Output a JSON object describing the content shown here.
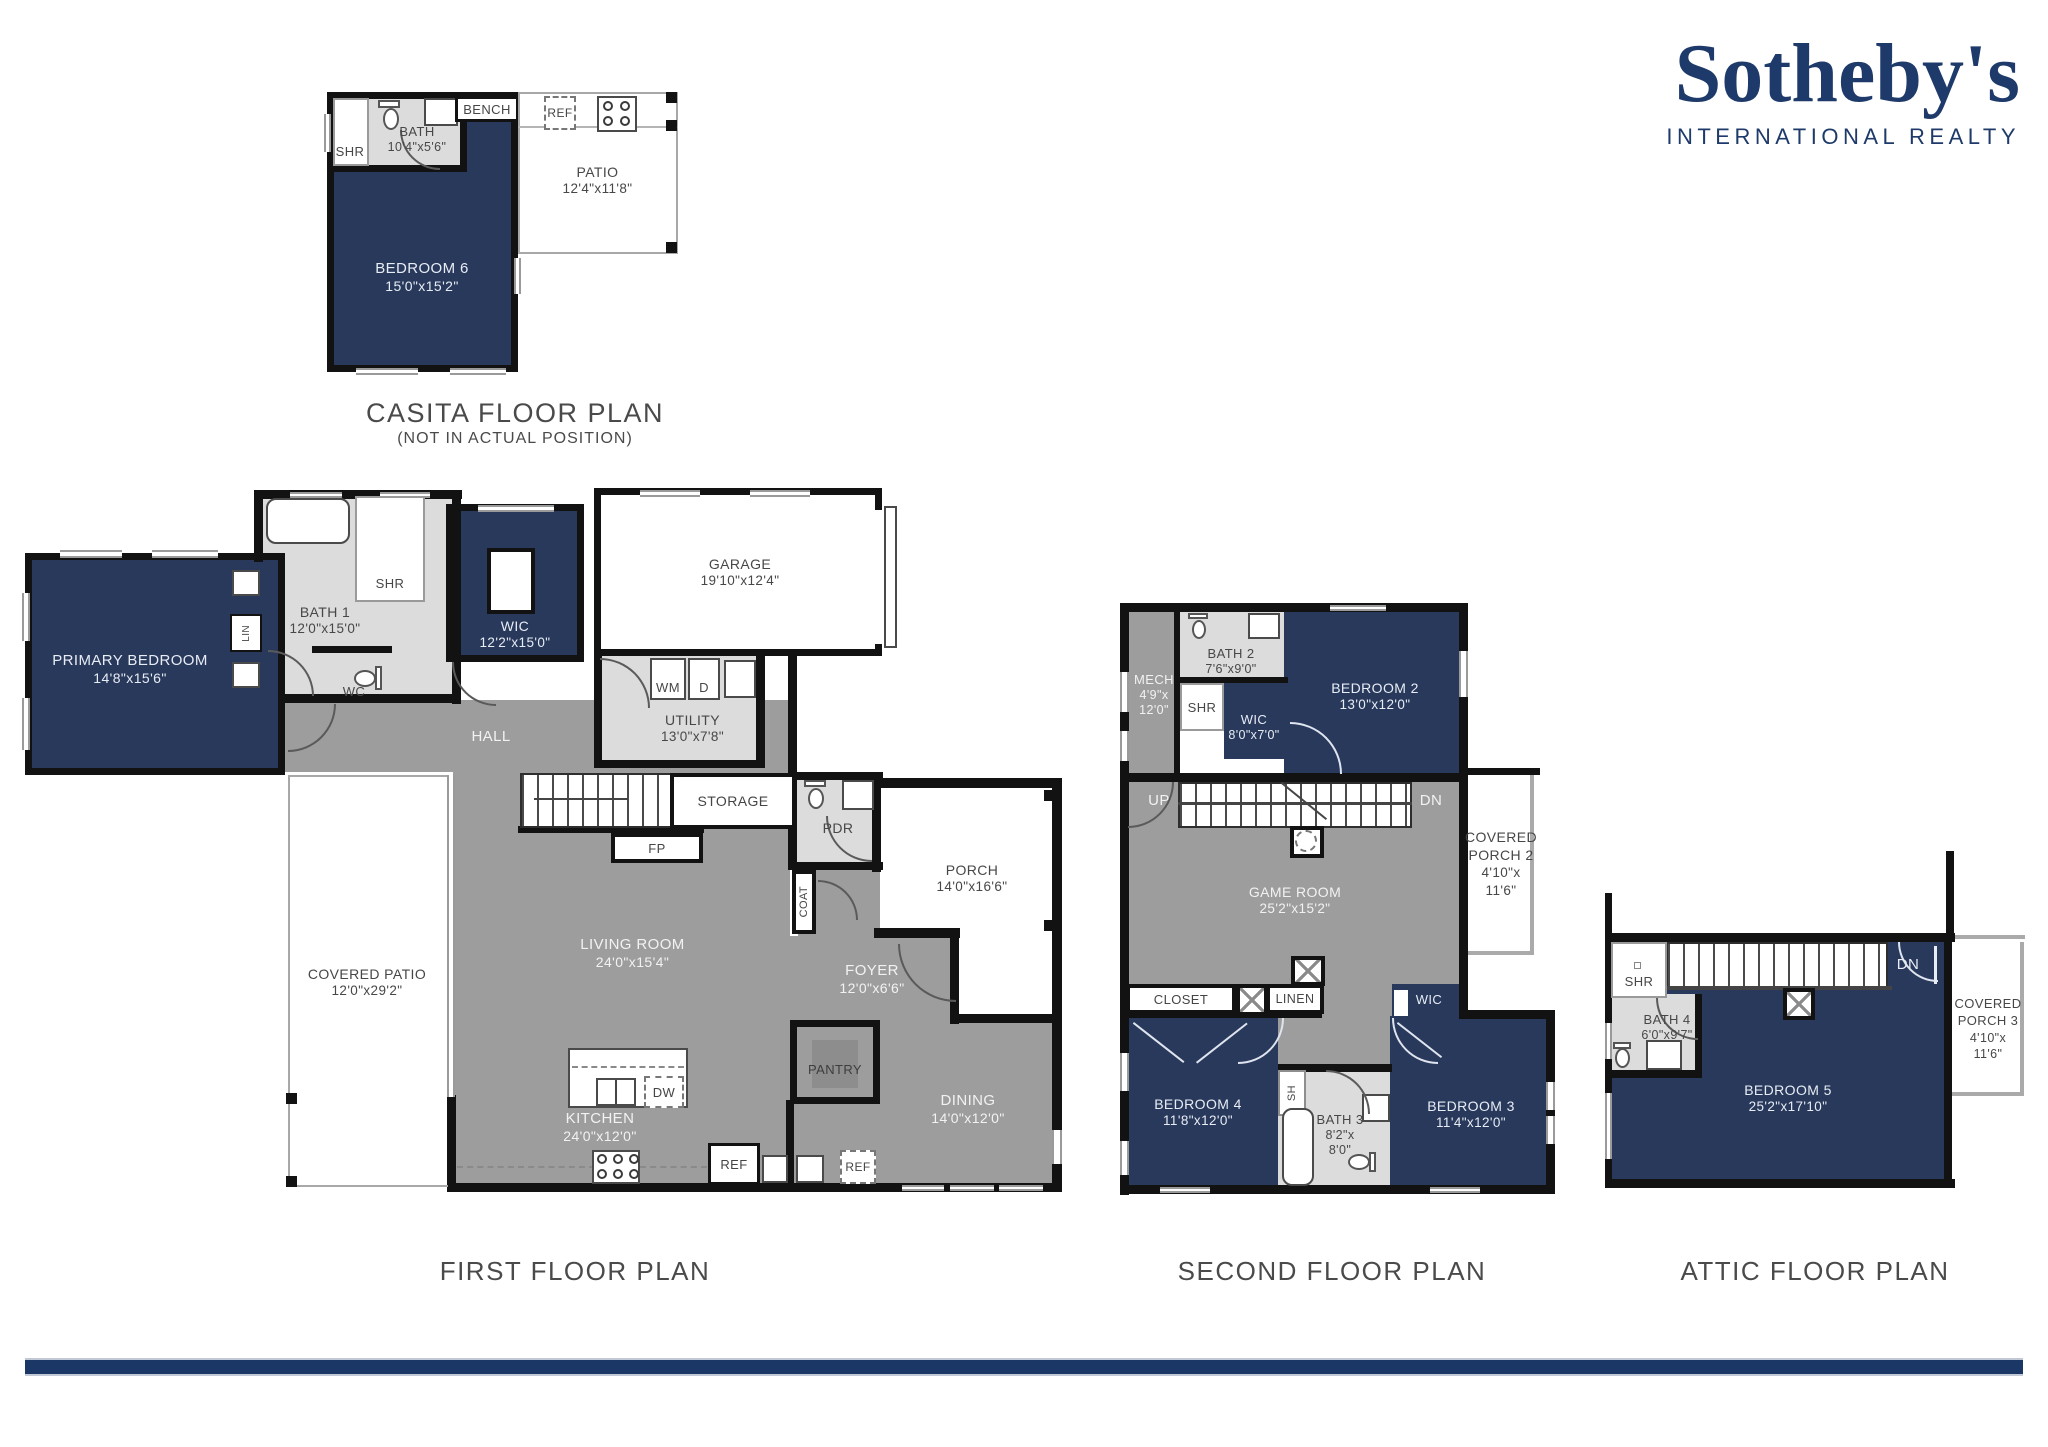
{
  "brand": {
    "wordmark": "Sotheby's",
    "tagline": "INTERNATIONAL REALTY"
  },
  "palette": {
    "brand_navy": "#1e3a6a",
    "room_navy": "#28395c",
    "floor_gray": "#9d9d9d",
    "wet_gray": "#dcdcdc",
    "wall_black": "#121212",
    "accent_bar": "#1b3766"
  },
  "plans": {
    "casita": {
      "title": "CASITA FLOOR PLAN",
      "subtitle": "(NOT IN ACTUAL POSITION)",
      "rooms": {
        "bath": {
          "name": "BATH",
          "dims": "10'4\"x5'6\""
        },
        "bedroom6": {
          "name": "BEDROOM 6",
          "dims": "15'0\"x15'2\""
        },
        "patio": {
          "name": "PATIO",
          "dims": "12'4\"x11'8\""
        }
      },
      "fixtures": {
        "shr": "SHR",
        "bench": "BENCH",
        "ref": "REF"
      }
    },
    "first": {
      "title": "FIRST FLOOR PLAN",
      "rooms": {
        "primary": {
          "name": "PRIMARY BEDROOM",
          "dims": "14'8\"x15'6\""
        },
        "bath1": {
          "name": "BATH 1",
          "dims": "12'0\"x15'0\""
        },
        "wic": {
          "name": "WIC",
          "dims": "12'2\"x15'0\""
        },
        "garage": {
          "name": "GARAGE",
          "dims": "19'10\"x12'4\""
        },
        "utility": {
          "name": "UTILITY",
          "dims": "13'0\"x7'8\""
        },
        "living": {
          "name": "LIVING ROOM",
          "dims": "24'0\"x15'4\""
        },
        "covered_patio": {
          "name": "COVERED PATIO",
          "dims": "12'0\"x29'2\""
        },
        "kitchen": {
          "name": "KITCHEN",
          "dims": "24'0\"x12'0\""
        },
        "foyer": {
          "name": "FOYER",
          "dims": "12'0\"x6'6\""
        },
        "porch": {
          "name": "PORCH",
          "dims": "14'0\"x16'6\""
        },
        "dining": {
          "name": "DINING",
          "dims": "14'0\"x12'0\""
        }
      },
      "fixtures": {
        "shr": "SHR",
        "wc": "WC",
        "lin": "LIN",
        "hall": "HALL",
        "storage": "STORAGE",
        "fp": "FP",
        "pdr": "PDR",
        "coat": "COAT",
        "wm": "WM",
        "d": "D",
        "dw": "DW",
        "ref_kitchen": "REF",
        "ref_dining": "REF",
        "pantry": "PANTRY"
      }
    },
    "second": {
      "title": "SECOND FLOOR PLAN",
      "rooms": {
        "mech": {
          "name": "MECH",
          "dims_a": "4'9\"x",
          "dims_b": "12'0\""
        },
        "bath2": {
          "name": "BATH 2",
          "dims": "7'6\"x9'0\""
        },
        "wic_bath2": {
          "name": "WIC",
          "dims": "8'0\"x7'0\""
        },
        "bedroom2": {
          "name": "BEDROOM 2",
          "dims": "13'0\"x12'0\""
        },
        "gameroom": {
          "name": "GAME ROOM",
          "dims": "25'2\"x15'2\""
        },
        "covered_porch2": {
          "line1": "COVERED",
          "line2": "PORCH 2",
          "line3": "4'10\"x",
          "line4": "11'6\""
        },
        "bedroom4": {
          "name": "BEDROOM 4",
          "dims": "11'8\"x12'0\""
        },
        "bath3": {
          "name": "BATH 3",
          "dims_a": "8'2\"x",
          "dims_b": "8'0\""
        },
        "bedroom3": {
          "name": "BEDROOM 3",
          "dims": "11'4\"x12'0\""
        }
      },
      "fixtures": {
        "shr": "SHR",
        "up": "UP",
        "dn": "DN",
        "closet": "CLOSET",
        "linen": "LINEN",
        "wic": "WIC",
        "sh": "SH"
      }
    },
    "attic": {
      "title": "ATTIC FLOOR PLAN",
      "rooms": {
        "bath4": {
          "name": "BATH 4",
          "dims": "6'0\"x9'7\""
        },
        "bedroom5": {
          "name": "BEDROOM 5",
          "dims": "25'2\"x17'10\""
        },
        "covered_porch3": {
          "line1": "COVERED",
          "line2": "PORCH 3",
          "line3": "4'10\"x",
          "line4": "11'6\""
        }
      },
      "fixtures": {
        "shr": "SHR",
        "dn": "DN"
      }
    }
  }
}
